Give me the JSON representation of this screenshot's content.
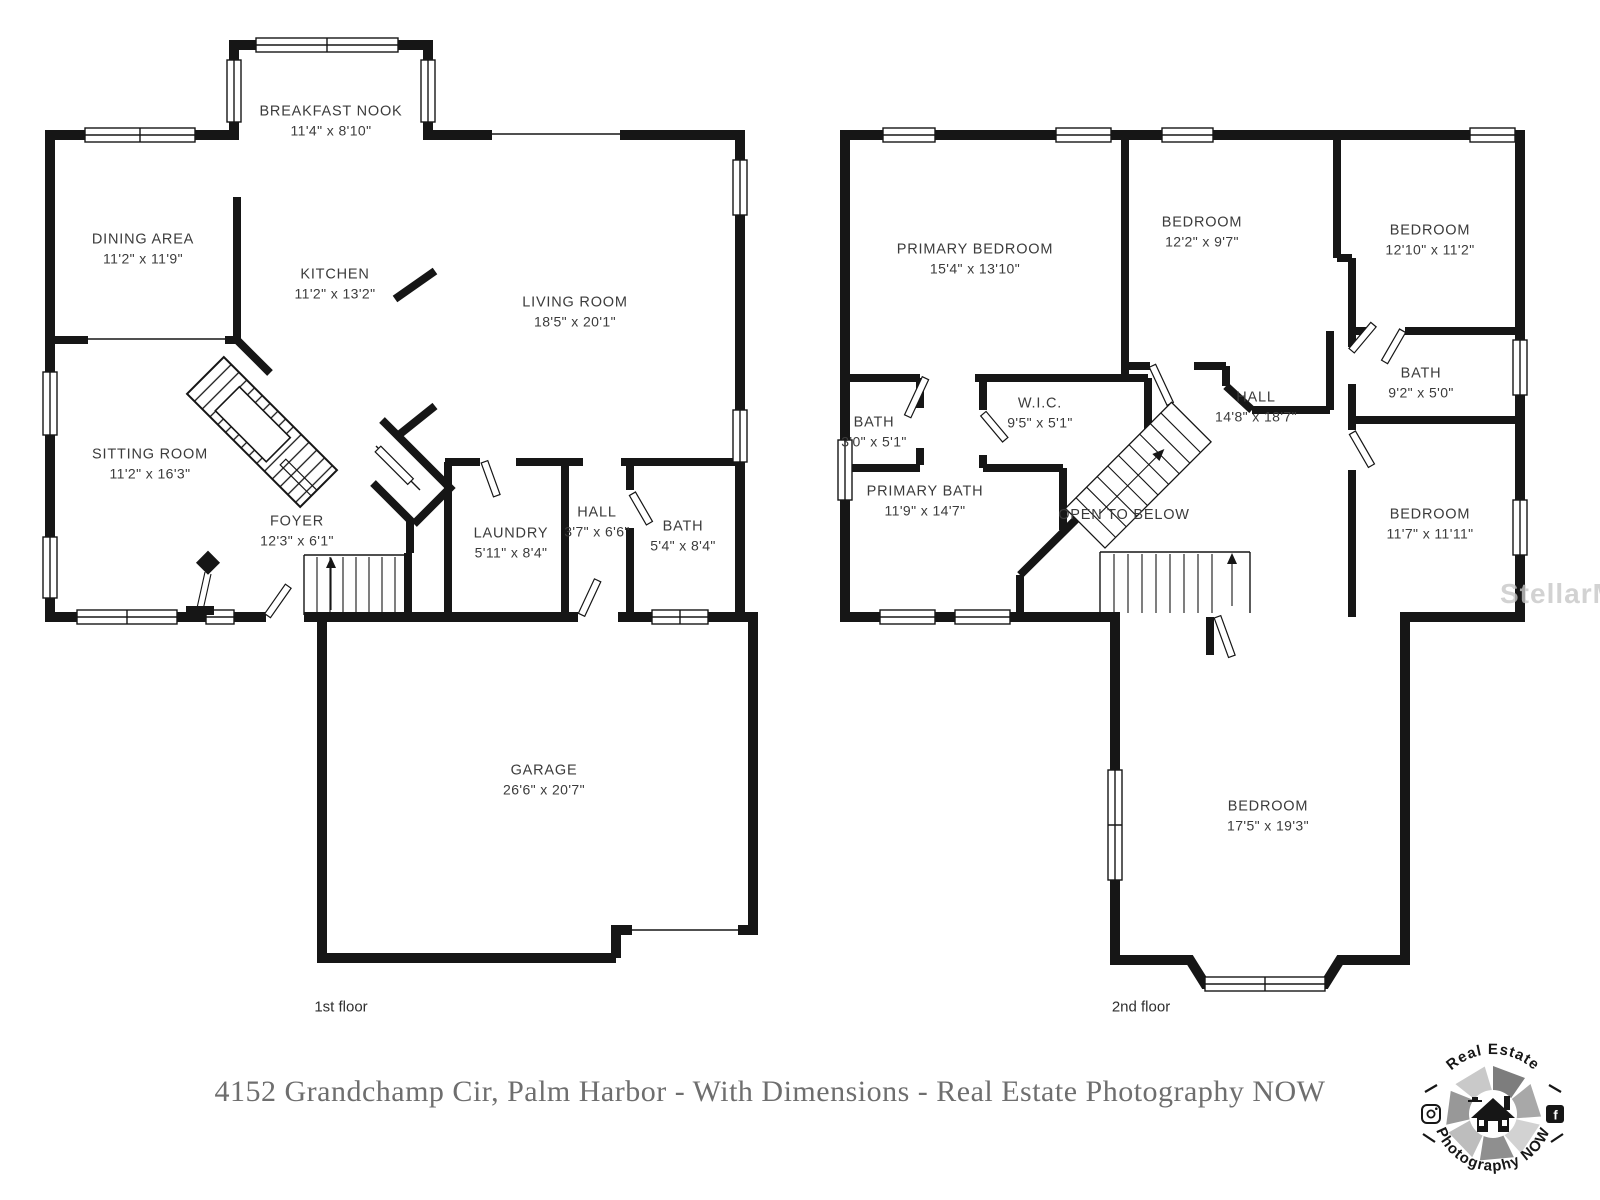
{
  "colors": {
    "wall": "#161616",
    "label_text": "#3b3b3b",
    "caption_text": "#6e6e6e",
    "watermark_text": "#c7c7c7"
  },
  "caption": {
    "text": "4152 Grandchamp Cir, Palm Harbor - With Dimensions - Real Estate Photography NOW"
  },
  "watermark": {
    "text": "StellarMLS"
  },
  "floor1": {
    "label": "1st floor",
    "rooms": {
      "breakfast_nook": {
        "name": "BREAKFAST NOOK",
        "dims": "11'4\" x 8'10\""
      },
      "dining_area": {
        "name": "DINING AREA",
        "dims": "11'2\" x 11'9\""
      },
      "kitchen": {
        "name": "KITCHEN",
        "dims": "11'2\" x 13'2\""
      },
      "living_room": {
        "name": "LIVING ROOM",
        "dims": "18'5\" x 20'1\""
      },
      "sitting_room": {
        "name": "SITTING ROOM",
        "dims": "11'2\" x 16'3\""
      },
      "foyer": {
        "name": "FOYER",
        "dims": "12'3\" x 6'1\""
      },
      "laundry": {
        "name": "LAUNDRY",
        "dims": "5'11\" x 8'4\""
      },
      "hall": {
        "name": "HALL",
        "dims": "3'7\" x 6'6\""
      },
      "bath": {
        "name": "BATH",
        "dims": "5'4\" x 8'4\""
      },
      "garage": {
        "name": "GARAGE",
        "dims": "26'6\" x 20'7\""
      }
    }
  },
  "floor2": {
    "label": "2nd floor",
    "rooms": {
      "primary_bedroom": {
        "name": "PRIMARY BEDROOM",
        "dims": "15'4\" x 13'10\""
      },
      "bedroom_a": {
        "name": "BEDROOM",
        "dims": "12'2\" x 9'7\""
      },
      "bedroom_b": {
        "name": "BEDROOM",
        "dims": "12'10\" x 11'2\""
      },
      "bath_a": {
        "name": "BATH",
        "dims": "3'0\" x 5'1\""
      },
      "wic": {
        "name": "W.I.C.",
        "dims": "9'5\" x 5'1\""
      },
      "hall": {
        "name": "HALL",
        "dims": "14'8\" x 18'7\""
      },
      "bath_b": {
        "name": "BATH",
        "dims": "9'2\" x 5'0\""
      },
      "primary_bath": {
        "name": "PRIMARY BATH",
        "dims": "11'9\" x 14'7\""
      },
      "open_to_below": {
        "name": "OPEN TO BELOW"
      },
      "bedroom_c": {
        "name": "BEDROOM",
        "dims": "11'7\" x 11'11\""
      },
      "bedroom_d": {
        "name": "BEDROOM",
        "dims": "17'5\" x 19'3\""
      }
    }
  },
  "logo": {
    "arc_top": "Real Estate",
    "arc_bottom": "Photography NOW",
    "facebook_glyph": "f"
  }
}
